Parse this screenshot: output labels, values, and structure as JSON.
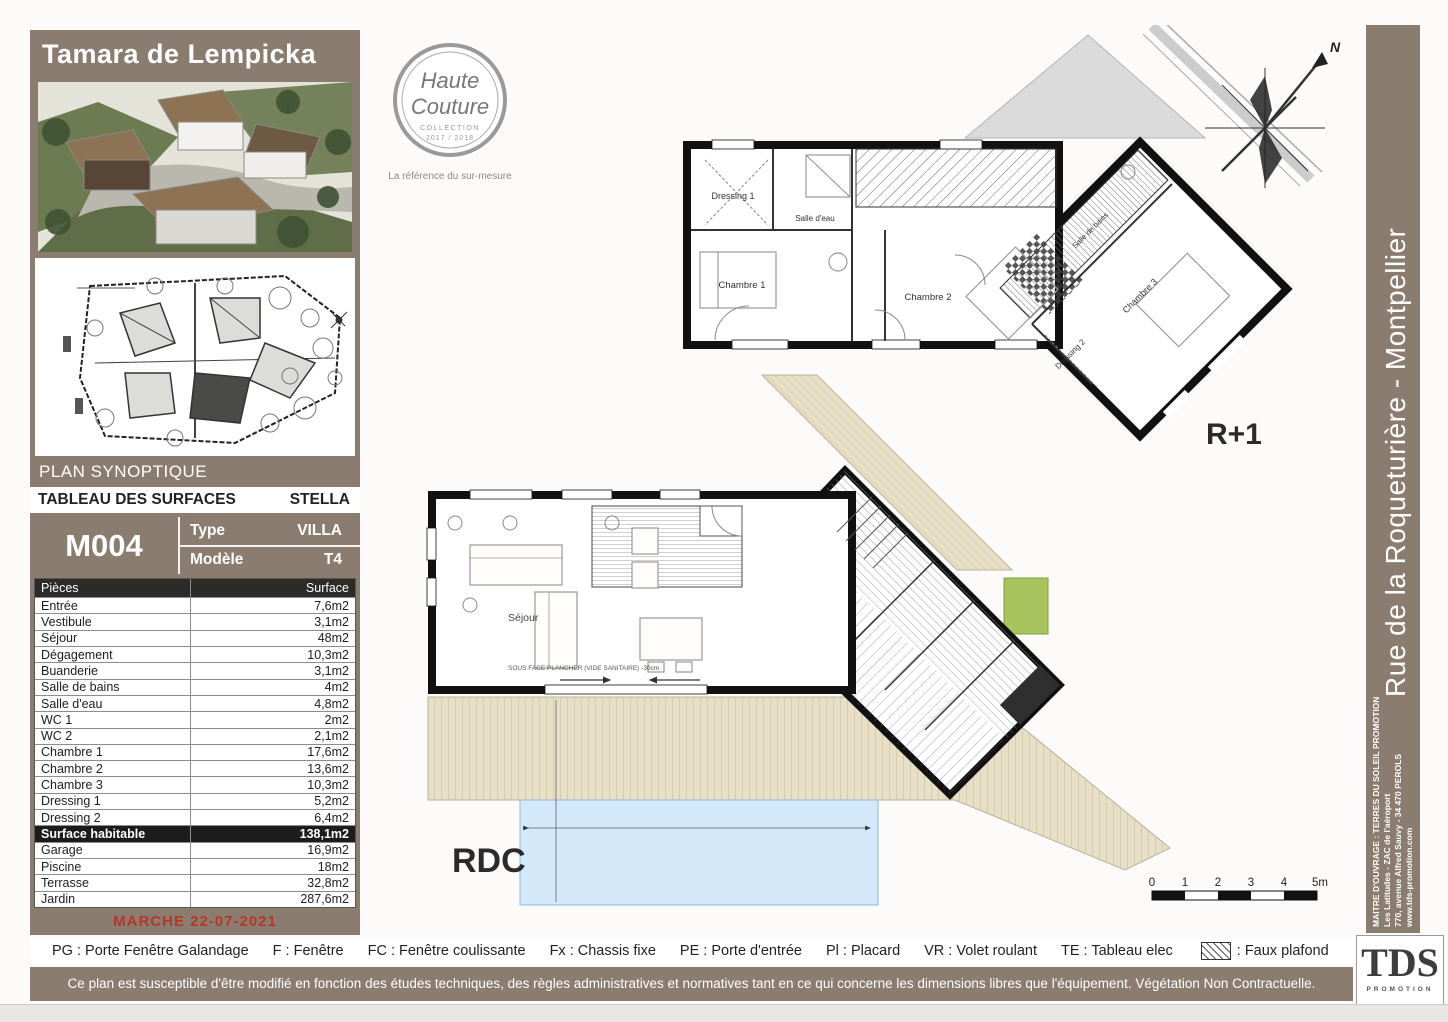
{
  "project": {
    "title": "Tamara de Lempicka",
    "plan_synoptique_label": "PLAN SYNOPTIQUE",
    "logo": {
      "script_line1": "Haute",
      "script_line2": "Couture",
      "collection": "COLLECTION",
      "years": "2017 / 2018",
      "tagline": "La référence du sur-mesure"
    }
  },
  "surface_table": {
    "title": "TABLEAU DES SURFACES",
    "name": "STELLA",
    "lot": "M004",
    "type_label": "Type",
    "type_value": "VILLA",
    "model_label": "Modèle",
    "model_value": "T4",
    "columns": [
      "Pièces",
      "Surface"
    ],
    "rows": [
      {
        "label": "Entrée",
        "value": "7,6m2"
      },
      {
        "label": "Vestibule",
        "value": "3,1m2"
      },
      {
        "label": "Séjour",
        "value": "48m2"
      },
      {
        "label": "Dégagement",
        "value": "10,3m2"
      },
      {
        "label": "Buanderie",
        "value": "3,1m2"
      },
      {
        "label": "Salle de bains",
        "value": "4m2"
      },
      {
        "label": "Salle d'eau",
        "value": "4,8m2"
      },
      {
        "label": "WC 1",
        "value": "2m2"
      },
      {
        "label": "WC 2",
        "value": "2,1m2"
      },
      {
        "label": "Chambre 1",
        "value": "17,6m2"
      },
      {
        "label": "Chambre 2",
        "value": "13,6m2"
      },
      {
        "label": "Chambre 3",
        "value": "10,3m2"
      },
      {
        "label": "Dressing 1",
        "value": "5,2m2"
      },
      {
        "label": "Dressing 2",
        "value": "6,4m2"
      },
      {
        "label": "Surface habitable",
        "value": "138,1m2",
        "highlight": true
      },
      {
        "label": "Garage",
        "value": "16,9m2"
      },
      {
        "label": "Piscine",
        "value": "18m2"
      },
      {
        "label": "Terrasse",
        "value": "32,8m2"
      },
      {
        "label": "Jardin",
        "value": "287,6m2"
      }
    ],
    "marche": "MARCHE 22-07-2021"
  },
  "plans": {
    "r1": {
      "label": "R+1",
      "rooms": {
        "dressing1": "Dressing 1",
        "salle_eau": "Salle d'eau",
        "chambre1": "Chambre 1",
        "chambre2": "Chambre 2",
        "salle_bains": "Salle de bains",
        "chambre3": "Chambre 3",
        "dressing2": "Dressing 2"
      }
    },
    "rdc": {
      "label": "RDC",
      "rooms": {
        "sejour": "Séjour"
      },
      "note": "SOUS FACE PLANCHER (VIDE SANITAIRE) -30cm"
    },
    "compass_north": "N",
    "scale_ticks": [
      "0",
      "1",
      "2",
      "3",
      "4",
      "5m"
    ]
  },
  "legend": {
    "items": [
      {
        "abbr": "PG",
        "label": "Porte Fenêtre Galandage"
      },
      {
        "abbr": "F",
        "label": "Fenêtre"
      },
      {
        "abbr": "FC",
        "label": "Fenêtre coulissante"
      },
      {
        "abbr": "Fx",
        "label": "Chassis fixe"
      },
      {
        "abbr": "PE",
        "label": "Porte d'entrée"
      },
      {
        "abbr": "Pl",
        "label": "Placard"
      },
      {
        "abbr": "VR",
        "label": "Volet roulant"
      },
      {
        "abbr": "TE",
        "label": "Tableau elec"
      }
    ],
    "hatch_label": ": Faux plafond"
  },
  "disclaimer": "Ce plan est susceptible d'être modifié en fonction des études techniques, des règles administratives et normatives tant en ce qui concerne les dimensions libres que l'équipement. Végétation Non Contractuelle.",
  "sidebar": {
    "street": "Rue de la Roqueturière - Montpellier",
    "owner": "MAITRE D'OUVRAGE : TERRES DU SOLEIL PROMOTION",
    "address1": "Les Latitudes - ZAC de l'aéroport",
    "address2": "770, avenue Alfred Sauvy - 34 470 PEROLS",
    "website": "www.tds-promotion.com",
    "brand": "TDS",
    "brand_sub": "PROMOTION"
  },
  "colors": {
    "brown": "#8a7c6f",
    "dark_header": "#2d2a27",
    "red_marche": "#b5372a",
    "deck_beige": "#e8e0c6",
    "pool_blue": "#d3e8f8",
    "grass_green": "#a9c45f"
  }
}
